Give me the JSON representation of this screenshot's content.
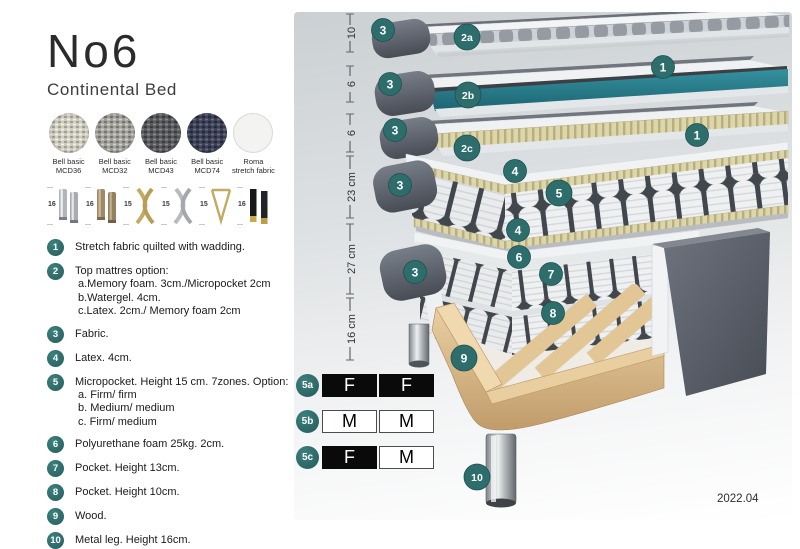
{
  "product": {
    "title": "No6",
    "subtitle": "Continental Bed"
  },
  "fabrics": [
    {
      "name": "Bell basic",
      "code": "MCD36",
      "texture": "woven",
      "base": "#cfccc0",
      "dot_light": "#f1efe8",
      "dot_dark": "#9a968a"
    },
    {
      "name": "Bell basic",
      "code": "MCD32",
      "texture": "woven",
      "base": "#a3a19c",
      "dot_light": "#d2d0cb",
      "dot_dark": "#6f6d68"
    },
    {
      "name": "Bell basic",
      "code": "MCD43",
      "texture": "woven",
      "base": "#595a5d",
      "dot_light": "#8a8b8e",
      "dot_dark": "#36373a"
    },
    {
      "name": "Bell basic",
      "code": "MCD74",
      "texture": "woven",
      "base": "#3d4156",
      "dot_light": "#6a6f88",
      "dot_dark": "#232634"
    },
    {
      "name": "Roma",
      "code": "stretch fabric",
      "texture": "plain",
      "base": "#f3f3f1",
      "dot_light": "#f3f3f1",
      "dot_dark": "#f3f3f1"
    }
  ],
  "legs": [
    {
      "height": "16",
      "type": "cylinder-silver"
    },
    {
      "height": "16",
      "type": "cylinder-bronze"
    },
    {
      "height": "15",
      "type": "cross-gold"
    },
    {
      "height": "15",
      "type": "cross-silver"
    },
    {
      "height": "15",
      "type": "hairpin-gold"
    },
    {
      "height": "16",
      "type": "taper-black-gold"
    }
  ],
  "features": [
    {
      "num": "1",
      "lines": [
        "Stretch fabric quilted with wadding."
      ]
    },
    {
      "num": "2",
      "lines": [
        "Top mattres option:",
        "a.Memory foam. 3cm./Micropocket 2cm",
        "b.Watergel. 4cm.",
        "c.Latex. 2cm./ Memory foam 2cm"
      ]
    },
    {
      "num": "3",
      "lines": [
        "Fabric."
      ]
    },
    {
      "num": "4",
      "lines": [
        "Latex. 4cm."
      ]
    },
    {
      "num": "5",
      "lines": [
        "Micropocket. Height 15 cm. 7zones. Option:",
        "a. Firm/ firm",
        "b. Medium/ medium",
        "c. Firm/ medium"
      ]
    },
    {
      "num": "6",
      "lines": [
        "Polyurethane foam 25kg. 2cm."
      ]
    },
    {
      "num": "7",
      "lines": [
        "Pocket. Height 13cm."
      ]
    },
    {
      "num": "8",
      "lines": [
        "Pocket. Height 10cm."
      ]
    },
    {
      "num": "9",
      "lines": [
        "Wood."
      ]
    },
    {
      "num": "10",
      "lines": [
        "Metal leg. Height 16cm."
      ]
    }
  ],
  "diagram": {
    "dimensions": [
      {
        "label": "10",
        "top": 14,
        "bottom": 52
      },
      {
        "label": "6",
        "top": 66,
        "bottom": 102
      },
      {
        "label": "6",
        "top": 114,
        "bottom": 152
      },
      {
        "label": "23 cm",
        "top": 156,
        "bottom": 218
      },
      {
        "label": "27 cm",
        "top": 224,
        "bottom": 294
      },
      {
        "label": "16 cm",
        "top": 298,
        "bottom": 360
      }
    ],
    "markers": [
      {
        "label": "3",
        "x": 383,
        "y": 30,
        "r": 11.5
      },
      {
        "label": "2a",
        "x": 467,
        "y": 37,
        "r": 13
      },
      {
        "label": "1",
        "x": 663,
        "y": 67,
        "r": 11.5
      },
      {
        "label": "3",
        "x": 390,
        "y": 84,
        "r": 11.5
      },
      {
        "label": "2b",
        "x": 468,
        "y": 95,
        "r": 13
      },
      {
        "label": "1",
        "x": 697,
        "y": 135,
        "r": 11.5
      },
      {
        "label": "3",
        "x": 395,
        "y": 130,
        "r": 11.5
      },
      {
        "label": "2c",
        "x": 467,
        "y": 148,
        "r": 13
      },
      {
        "label": "3",
        "x": 400,
        "y": 185,
        "r": 11.5
      },
      {
        "label": "4",
        "x": 515,
        "y": 171,
        "r": 11.5
      },
      {
        "label": "5",
        "x": 559,
        "y": 193,
        "r": 13
      },
      {
        "label": "4",
        "x": 518,
        "y": 230,
        "r": 11.5
      },
      {
        "label": "3",
        "x": 415,
        "y": 272,
        "r": 11.5
      },
      {
        "label": "6",
        "x": 519,
        "y": 257,
        "r": 11.5
      },
      {
        "label": "7",
        "x": 551,
        "y": 274,
        "r": 11.5
      },
      {
        "label": "8",
        "x": 553,
        "y": 313,
        "r": 11.5
      },
      {
        "label": "9",
        "x": 464,
        "y": 358,
        "r": 13
      },
      {
        "label": "10",
        "x": 477,
        "y": 477,
        "r": 13
      }
    ]
  },
  "firmness": {
    "rows": [
      {
        "badge": "5a",
        "cells": [
          {
            "value": "F",
            "style": "dark"
          },
          {
            "value": "F",
            "style": "dark"
          }
        ]
      },
      {
        "badge": "5b",
        "cells": [
          {
            "value": "M",
            "style": "light"
          },
          {
            "value": "M",
            "style": "light"
          }
        ]
      },
      {
        "badge": "5c",
        "cells": [
          {
            "value": "F",
            "style": "dark"
          },
          {
            "value": "M",
            "style": "light"
          }
        ]
      }
    ]
  },
  "footer": {
    "version": "2022.04"
  },
  "colors": {
    "accent_teal": "#2d6e6d",
    "accent_teal_edge": "#1e4f4e",
    "layer_teal": "#2a7f8e"
  }
}
